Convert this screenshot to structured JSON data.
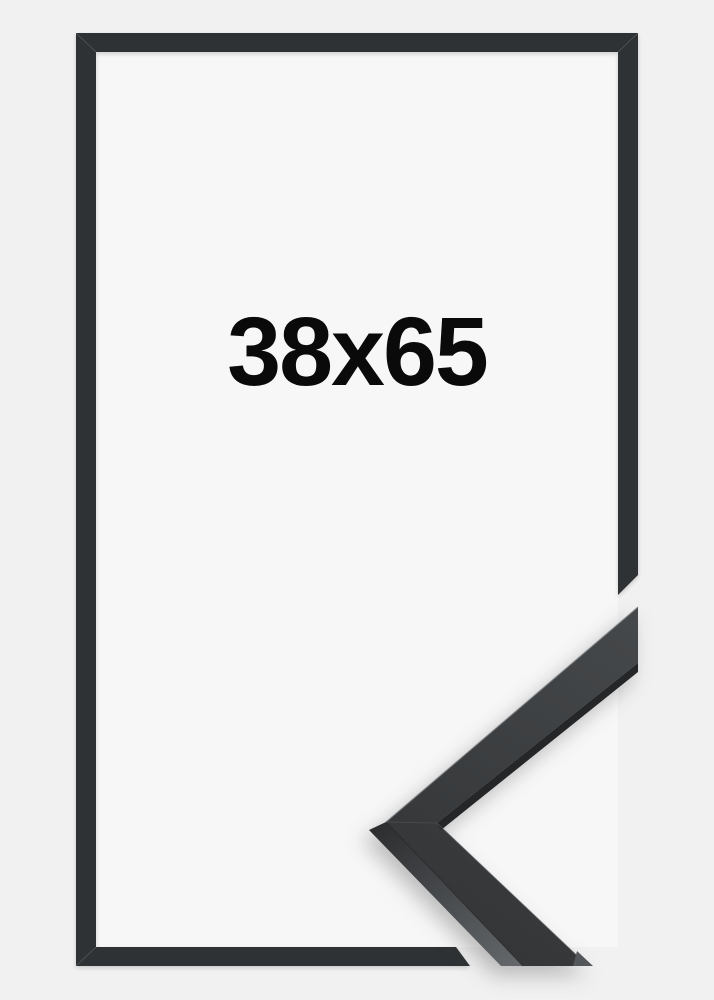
{
  "product": {
    "size_label": "38x65"
  },
  "colors": {
    "background": "#f1f1f2",
    "inner_background": "#f7f7f7",
    "frame_border": "#2f3234",
    "corner_face_light": "#46494b",
    "corner_face_dark": "#343638",
    "corner_side_dark": "#2c2e30",
    "corner_side_light": "#636669",
    "corner_inner_band": "#242628",
    "corner_tip_sliver": "#54575a",
    "label_text": "#0a0a0a"
  }
}
